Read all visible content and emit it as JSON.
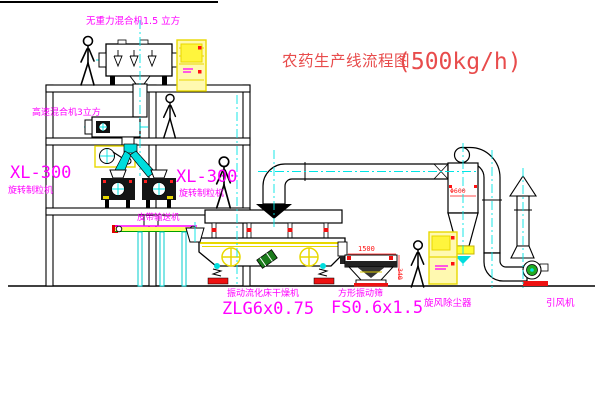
{
  "title": {
    "text": "农药生产线流程图",
    "capacity": "(500kg/h)"
  },
  "labels": {
    "gravity_mixer": "无重力混合机1.5 立方",
    "high_speed_mixer": "高速混合机3立方",
    "granulator_left_model": "XL-300",
    "granulator_left_name": "旋转制粒机",
    "granulator_right_model": "XL-300",
    "granulator_right_name": "旋转制粒机",
    "belt_conveyor": "皮带输送机",
    "dryer_name": "振动流化床干燥机",
    "dryer_model": "ZLG6x0.75",
    "sieve_name": "方形振动筛",
    "sieve_model": "FS0.6x1.5",
    "cyclone": "旋风除尘器",
    "fan": "引风机"
  },
  "dimensions": {
    "sieve_length": "1500",
    "sieve_height": "340",
    "cyclone_diameter": "Φ600"
  },
  "colors": {
    "label_magenta": "#ff00ff",
    "title_red": "#e84c4c",
    "dimension_red": "#ff1111",
    "centerline_cyan": "#00e5e5",
    "equipment_yellow": "#e8d800",
    "line_black": "#000000",
    "fan_green": "#22aa22"
  }
}
